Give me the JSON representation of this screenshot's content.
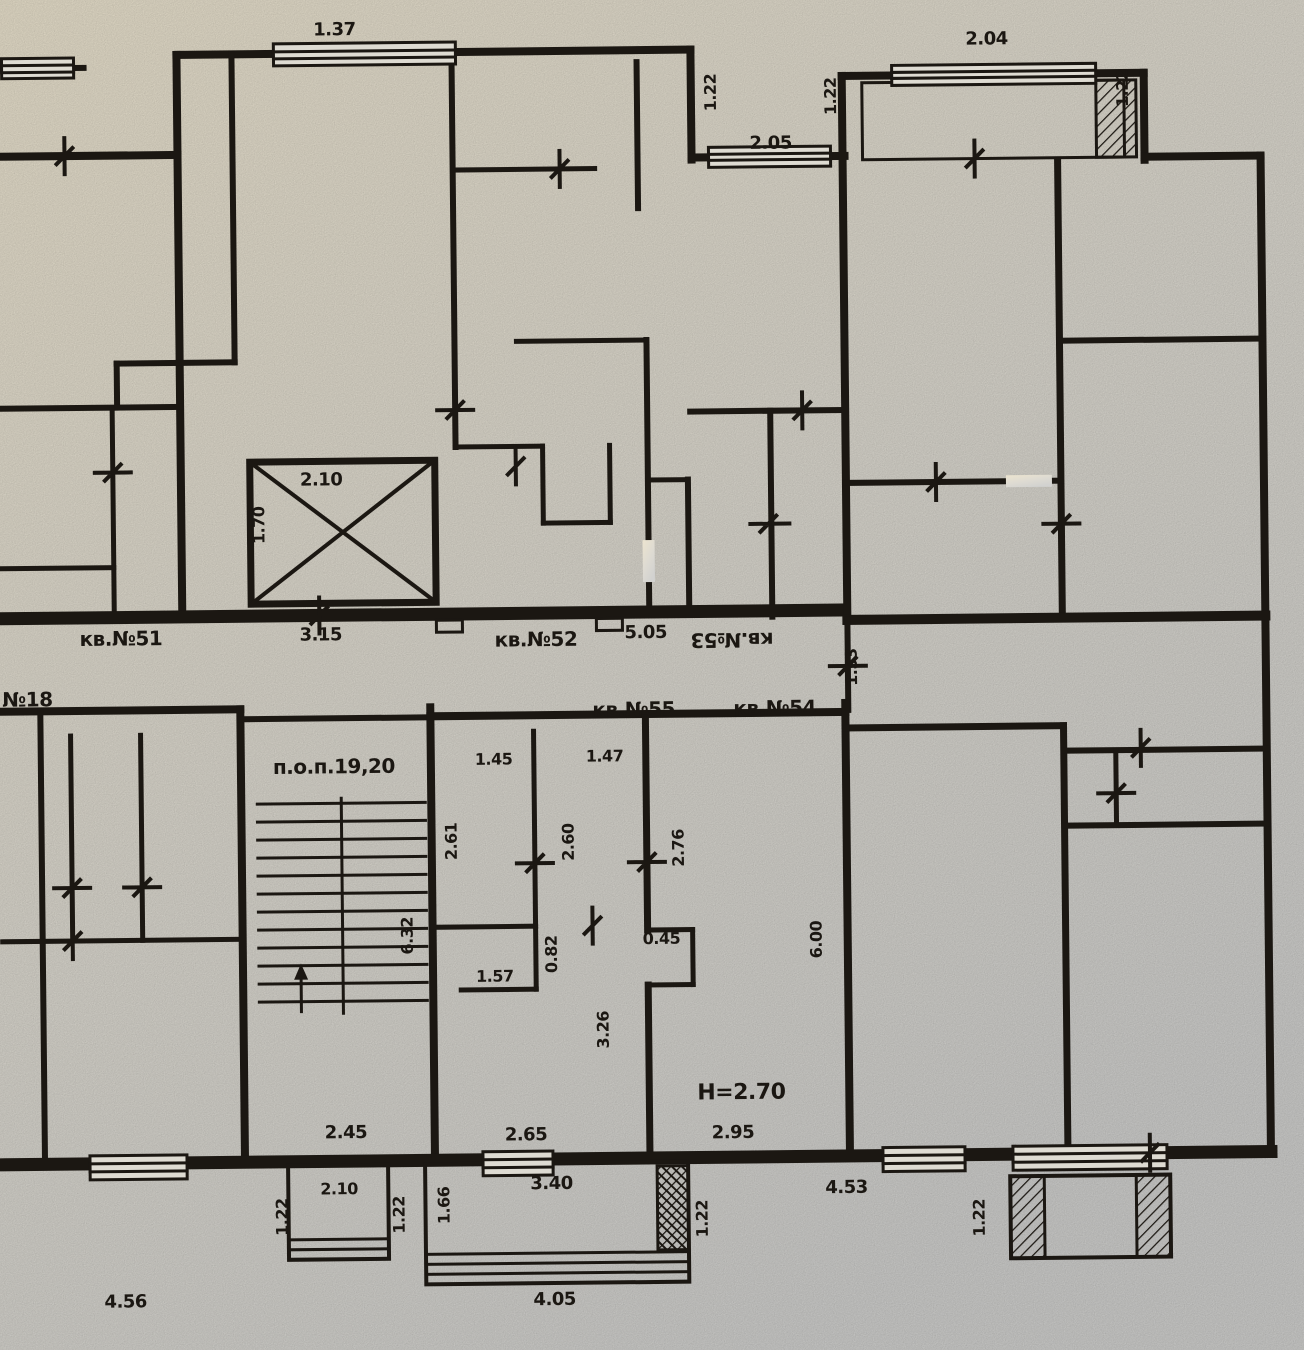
{
  "plan": {
    "kind": "apartment-floor-plan-scan",
    "apartments": {
      "kv18": "№18",
      "kv51": "кв.№51",
      "kv52": "кв.№52",
      "kv53": "кв.№53",
      "kv54": "кв.№54",
      "kv55": "кв.№55",
      "common_area": "п.о.п.19,20",
      "ceiling_height": "Н=2.70"
    },
    "dims": {
      "d137": "1.37",
      "d205": "2.05",
      "d122_top_left": "1.22",
      "d122_top_right": "1.22",
      "d204": "2.04",
      "d122_far_right": "1.22",
      "d210_lift": "2.10",
      "d170_lift": "1.70",
      "d315": "3.15",
      "d505": "5.05",
      "d153": "1.53",
      "d145": "1.45",
      "d147": "1.47",
      "d261": "2.61",
      "d260": "2.60",
      "d276": "2.76",
      "d632": "6.32",
      "d082": "0.82",
      "d045": "0.45",
      "d157": "1.57",
      "d326": "3.26",
      "d600": "6.00",
      "d245": "2.45",
      "d265": "2.65",
      "d295": "2.95",
      "d122_balc_l": "1.22",
      "d210_balc": "2.10",
      "d122_balc_r": "1.22",
      "d166": "1.66",
      "d340": "3.40",
      "d122_mid": "1.22",
      "d453": "4.53",
      "d122_br": "1.22",
      "d456": "4.56",
      "d405": "4.05"
    }
  },
  "colors": {
    "ink": "#1b1712",
    "paper_top": "#ece4cf",
    "paper_mid": "#dedbd2",
    "paper_bottom": "#d2d2d0"
  }
}
